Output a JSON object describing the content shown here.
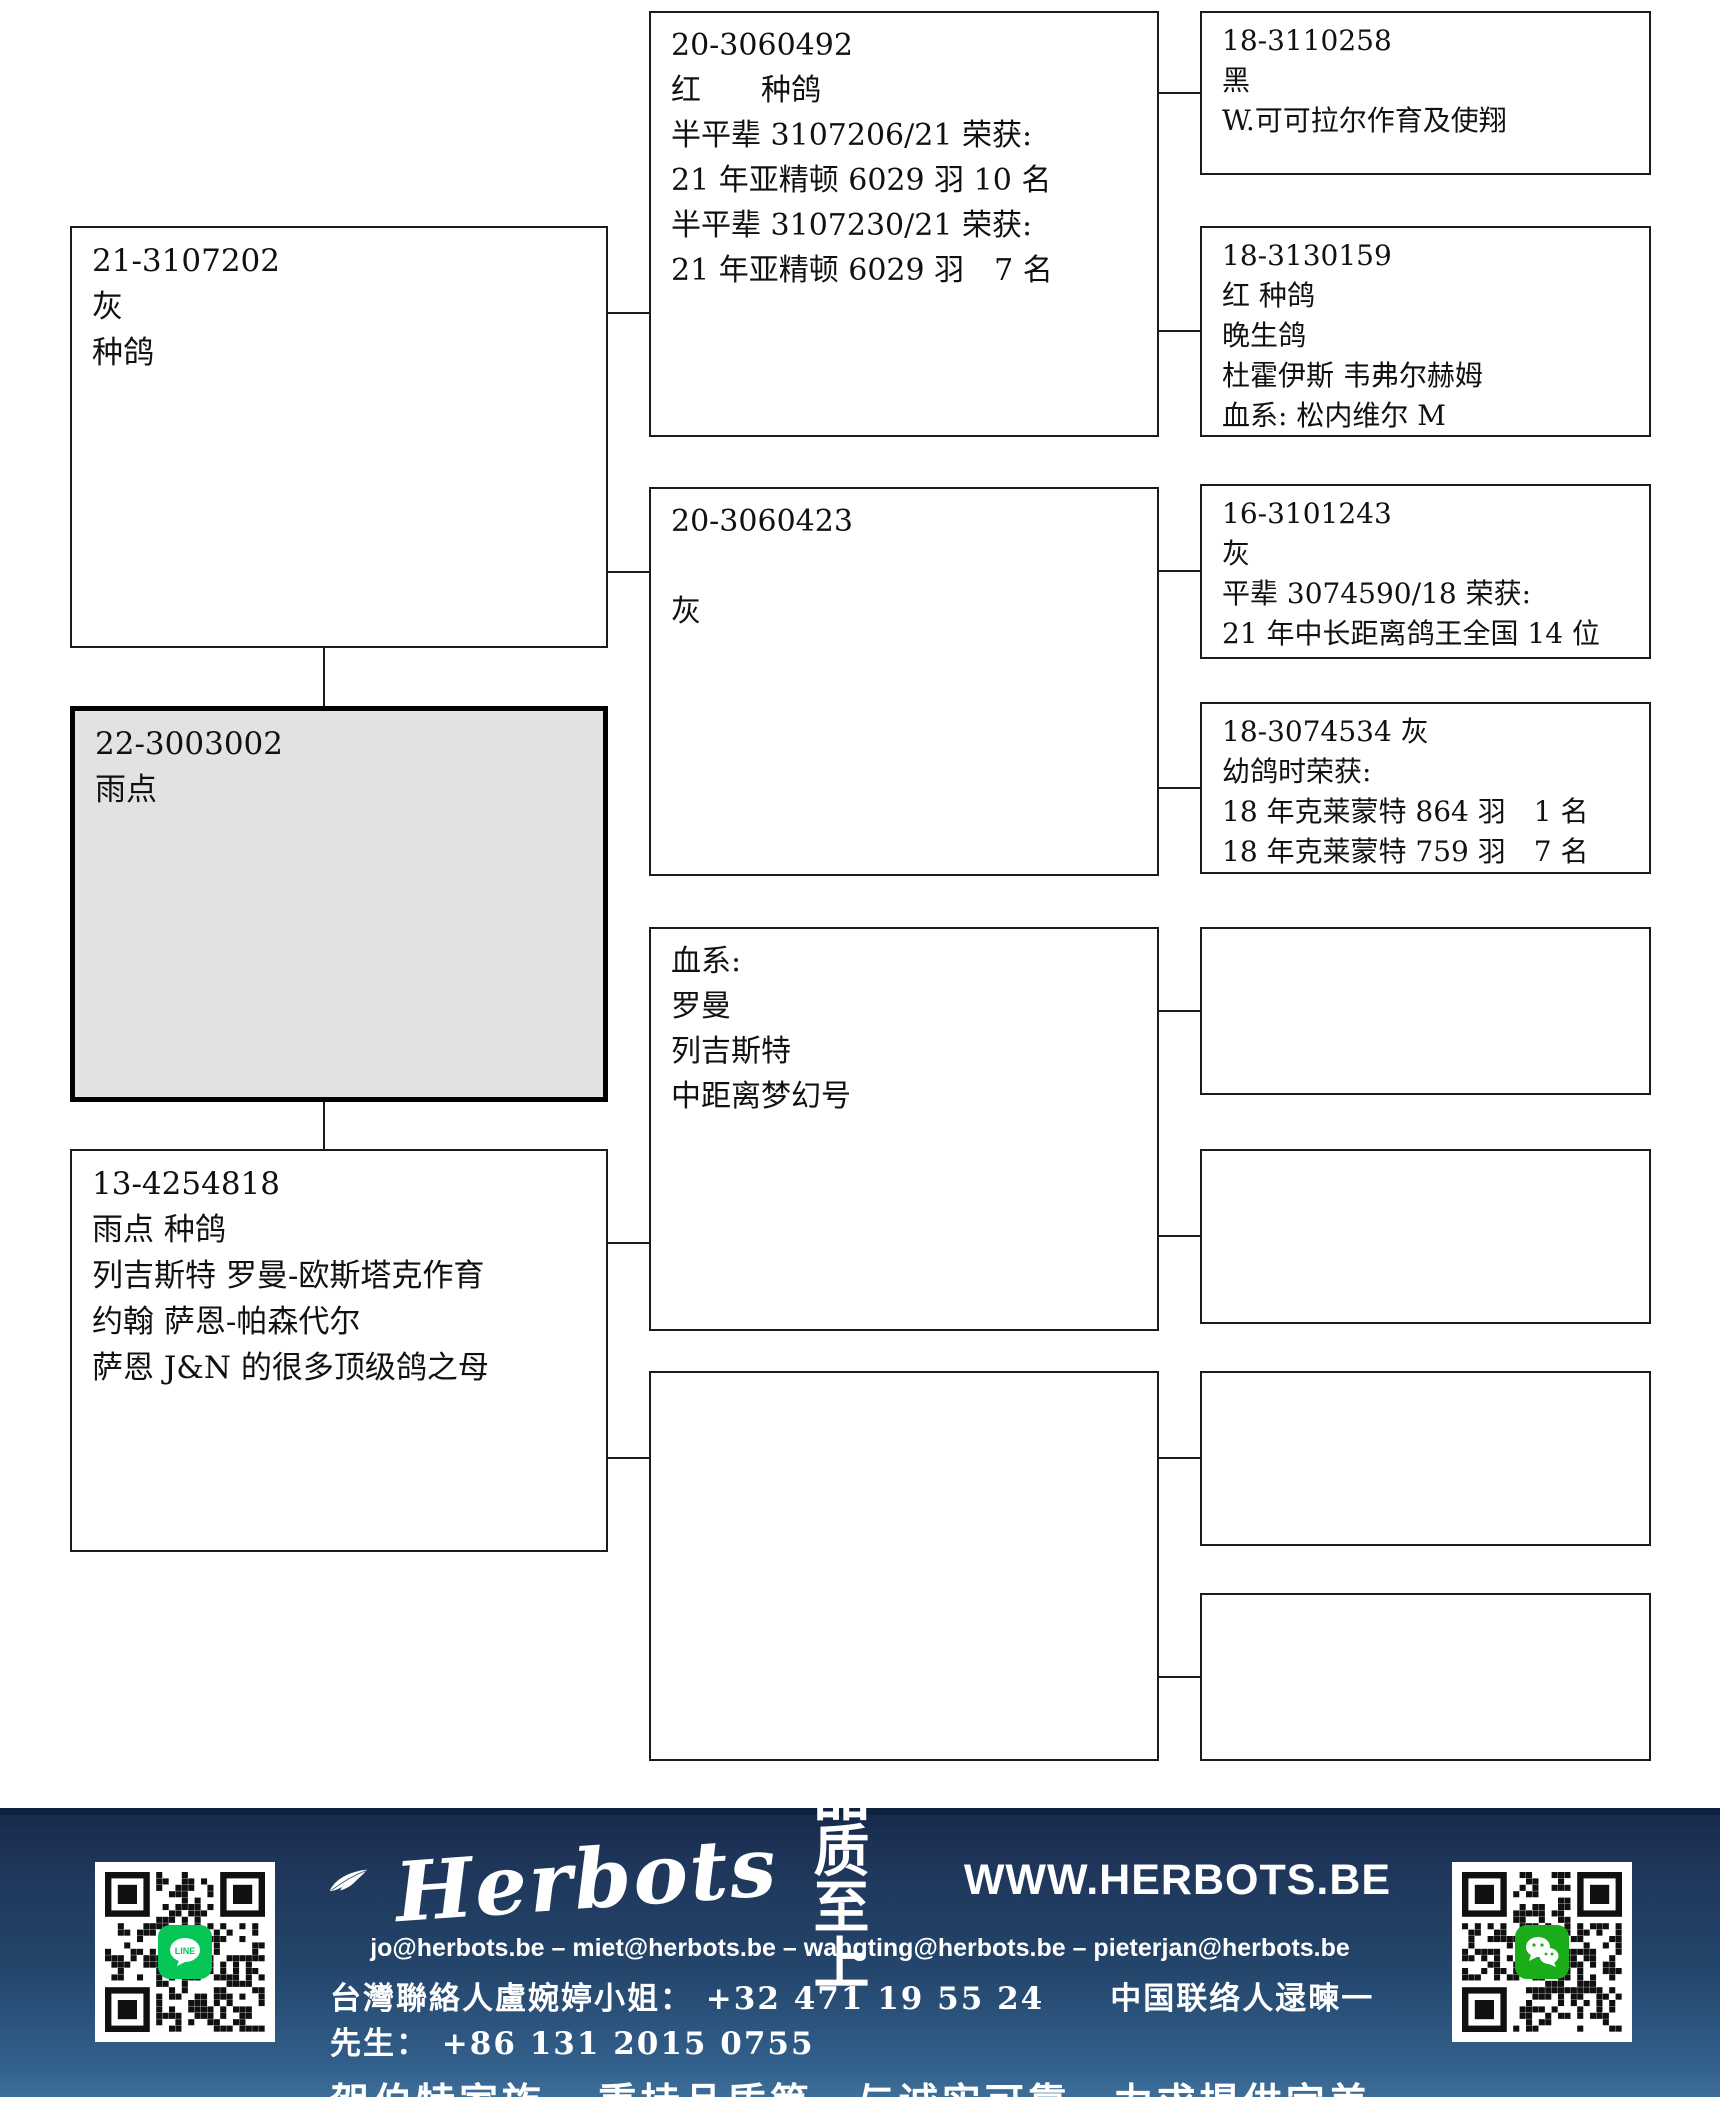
{
  "pedigree": {
    "father": {
      "lines": [
        "21-3107202",
        "灰",
        "种鸽"
      ]
    },
    "subject": {
      "lines": [
        "22-3003002",
        "雨点"
      ],
      "highlight_color": "#e2e2e2"
    },
    "mother": {
      "lines": [
        "13-4254818",
        "雨点 种鸽",
        "列吉斯特 罗曼-欧斯塔克作育",
        "约翰 萨恩-帕森代尔",
        "萨恩 J&N 的很多顶级鸽之母"
      ]
    },
    "grandparents": [
      {
        "position": "paternal-grandfather",
        "lines": [
          "20-3060492",
          "红　　种鸽",
          "半平辈 3107206/21 荣获:",
          "21 年亚精顿 6029 羽 10 名",
          "半平辈 3107230/21 荣获:",
          "21 年亚精顿 6029 羽　7 名"
        ]
      },
      {
        "position": "paternal-grandmother",
        "lines": [
          "20-3060423",
          "",
          "灰"
        ]
      },
      {
        "position": "maternal-grandfather",
        "lines": [
          "血系:",
          "罗曼",
          "列吉斯特",
          "中距离梦幻号"
        ]
      },
      {
        "position": "maternal-grandmother",
        "lines": []
      }
    ],
    "great_grandparents": [
      {
        "lines": [
          "18-3110258",
          "黑",
          "W.可可拉尔作育及使翔"
        ]
      },
      {
        "lines": [
          "18-3130159",
          "红 种鸽",
          "晚生鸽",
          "杜霍伊斯 韦弗尔赫姆",
          "血系: 松内维尔 M"
        ]
      },
      {
        "lines": [
          "16-3101243",
          "灰",
          "平辈 3074590/18 荣获:",
          "21 年中长距离鸽王全国 14 位"
        ]
      },
      {
        "lines": [
          "18-3074534 灰",
          "幼鸽时荣获:",
          "18 年克莱蒙特 864 羽　1 名",
          "18 年克莱蒙特 759 羽　7 名"
        ]
      },
      {
        "lines": []
      },
      {
        "lines": []
      },
      {
        "lines": []
      },
      {
        "lines": []
      }
    ]
  },
  "footer": {
    "brand": "Herbots",
    "tagline": "品质至上",
    "website": "WWW.HERBOTS.BE",
    "emails": "jo@herbots.be – miet@herbots.be – wangting@herbots.be – pieterjan@herbots.be",
    "contacts": "台灣聯絡人盧婉婷小姐： +32 471 19 55 24　　中国联络人逯暕一先生： +86 131 2015 0755",
    "slogan": "贺伯特家族...秉持品质第一与诚实可靠，力求提供完美的服务！",
    "icons": {
      "left_qr": "line-qr-code",
      "right_qr": "wechat-qr-code",
      "line_label": "LINE"
    },
    "colors": {
      "navy_top": "#16284a",
      "navy_bottom": "#3e6f99",
      "line_green": "#06c755",
      "wechat_green": "#1aad19"
    }
  }
}
